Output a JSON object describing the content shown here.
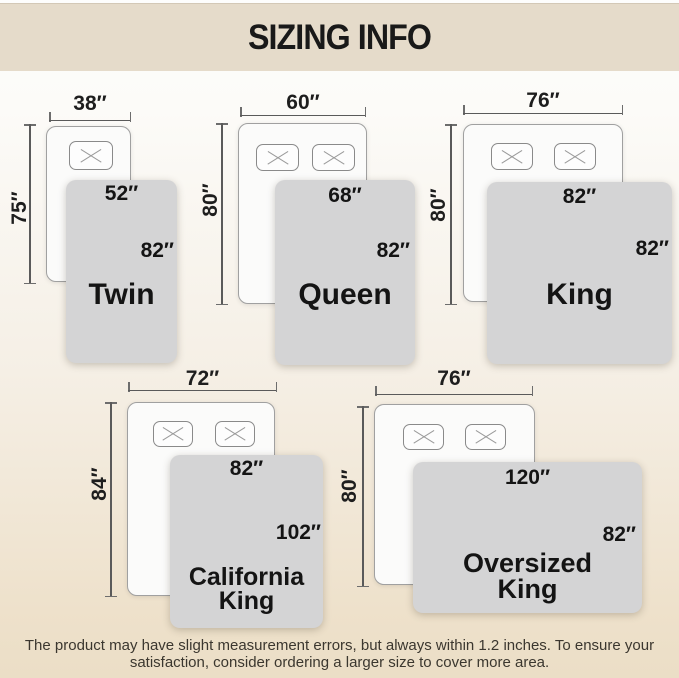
{
  "title": "SIZING INFO",
  "diagrams": [
    {
      "name_line1": "Twin",
      "name_line2": "",
      "bed_width": "38″",
      "bed_length": "75″",
      "blanket_width": "52″",
      "blanket_length": "82″",
      "pillows": 1
    },
    {
      "name_line1": "Queen",
      "name_line2": "",
      "bed_width": "60″",
      "bed_length": "80″",
      "blanket_width": "68″",
      "blanket_length": "82″",
      "pillows": 2
    },
    {
      "name_line1": "King",
      "name_line2": "",
      "bed_width": "76″",
      "bed_length": "80″",
      "blanket_width": "82″",
      "blanket_length": "82″",
      "pillows": 2
    },
    {
      "name_line1": "California",
      "name_line2": "King",
      "bed_width": "72″",
      "bed_length": "84″",
      "blanket_width": "82″",
      "blanket_length": "102″",
      "pillows": 2
    },
    {
      "name_line1": "Oversized",
      "name_line2": "King",
      "bed_width": "76″",
      "bed_length": "80″",
      "blanket_width": "120″",
      "blanket_length": "82″",
      "pillows": 2
    }
  ],
  "footer": {
    "line1": "The product may have slight measurement errors, but always within 1.2 inches. To ensure your",
    "line2": "satisfaction, consider ordering a larger size to cover more area."
  },
  "colors": {
    "header_bg": "#e5dbca",
    "page_bottom": "#ebdec6",
    "blanket_fill": "#d4d4d5",
    "bed_fill": "#fbfbfa",
    "measure_line": "#5a5a5a",
    "title_text": "#191919",
    "footer_text": "#3b372f"
  }
}
